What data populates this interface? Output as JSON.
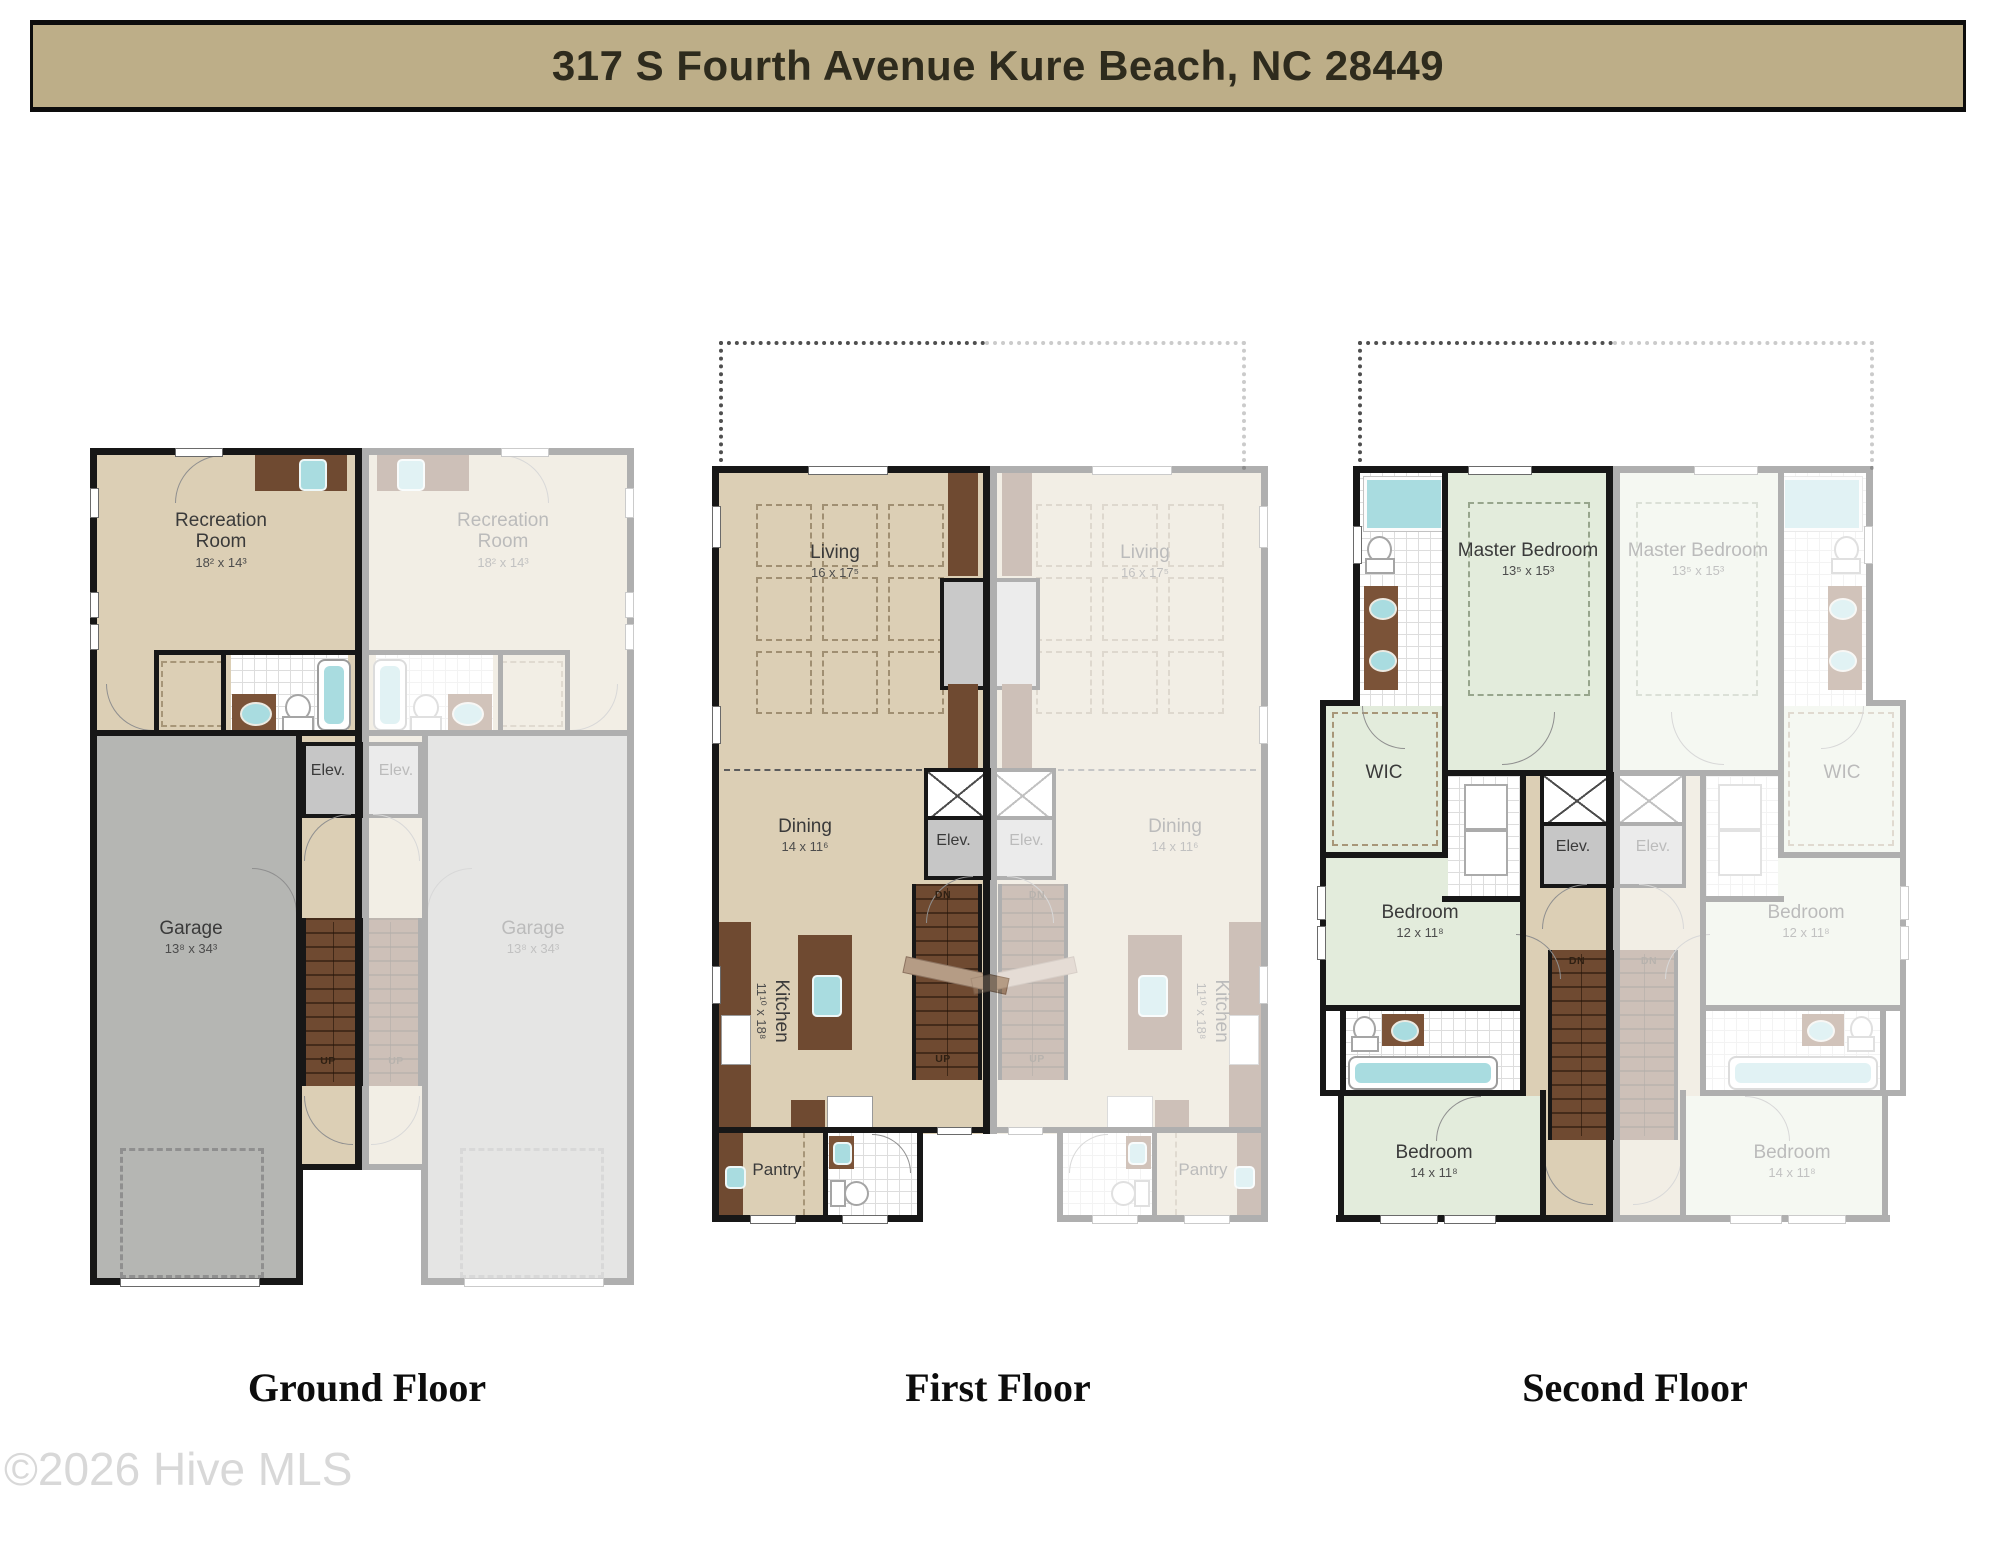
{
  "header": {
    "title": "317 S Fourth Avenue Kure Beach, NC 28449"
  },
  "watermark": "©2026 Hive MLS",
  "colors": {
    "banner_bg": "#bdae88",
    "wall": "#171717",
    "floor_tan": "#dccfb5",
    "floor_green": "#e3ecdc",
    "garage_gray": "#b5b6b3",
    "stair_brown": "#6f4a31",
    "cabinet_brown": "#7b5338",
    "fixture_teal": "#a9dce0",
    "elevator_gray": "#c6c6c6",
    "faded_unit_opacity": "0.34"
  },
  "plans": {
    "ground": {
      "caption": "Ground Floor",
      "rooms": {
        "recreation": {
          "name": "Recreation Room",
          "dims": "18² x 14³"
        },
        "garage": {
          "name": "Garage",
          "dims": "13⁸ x 34³"
        },
        "elevator": {
          "name": "Elev."
        }
      },
      "stairs": {
        "up": "UP"
      }
    },
    "first": {
      "caption": "First Floor",
      "rooms": {
        "living": {
          "name": "Living",
          "dims": "16 x 17⁵"
        },
        "dining": {
          "name": "Dining",
          "dims": "14 x 11⁶"
        },
        "kitchen": {
          "name": "Kitchen",
          "dims": "11¹⁰ x 18⁸"
        },
        "pantry": {
          "name": "Pantry"
        },
        "elevator": {
          "name": "Elev."
        }
      },
      "stairs": {
        "down": "DN",
        "up": "UP"
      }
    },
    "second": {
      "caption": "Second Floor",
      "rooms": {
        "master": {
          "name": "Master Bedroom",
          "dims": "13⁵ x 15³"
        },
        "wic": {
          "name": "WIC"
        },
        "bedroom_mid": {
          "name": "Bedroom",
          "dims": "12 x 11⁸"
        },
        "bedroom_rear": {
          "name": "Bedroom",
          "dims": "14 x 11⁸"
        },
        "elevator": {
          "name": "Elev."
        }
      },
      "stairs": {
        "down": "DN"
      }
    }
  }
}
